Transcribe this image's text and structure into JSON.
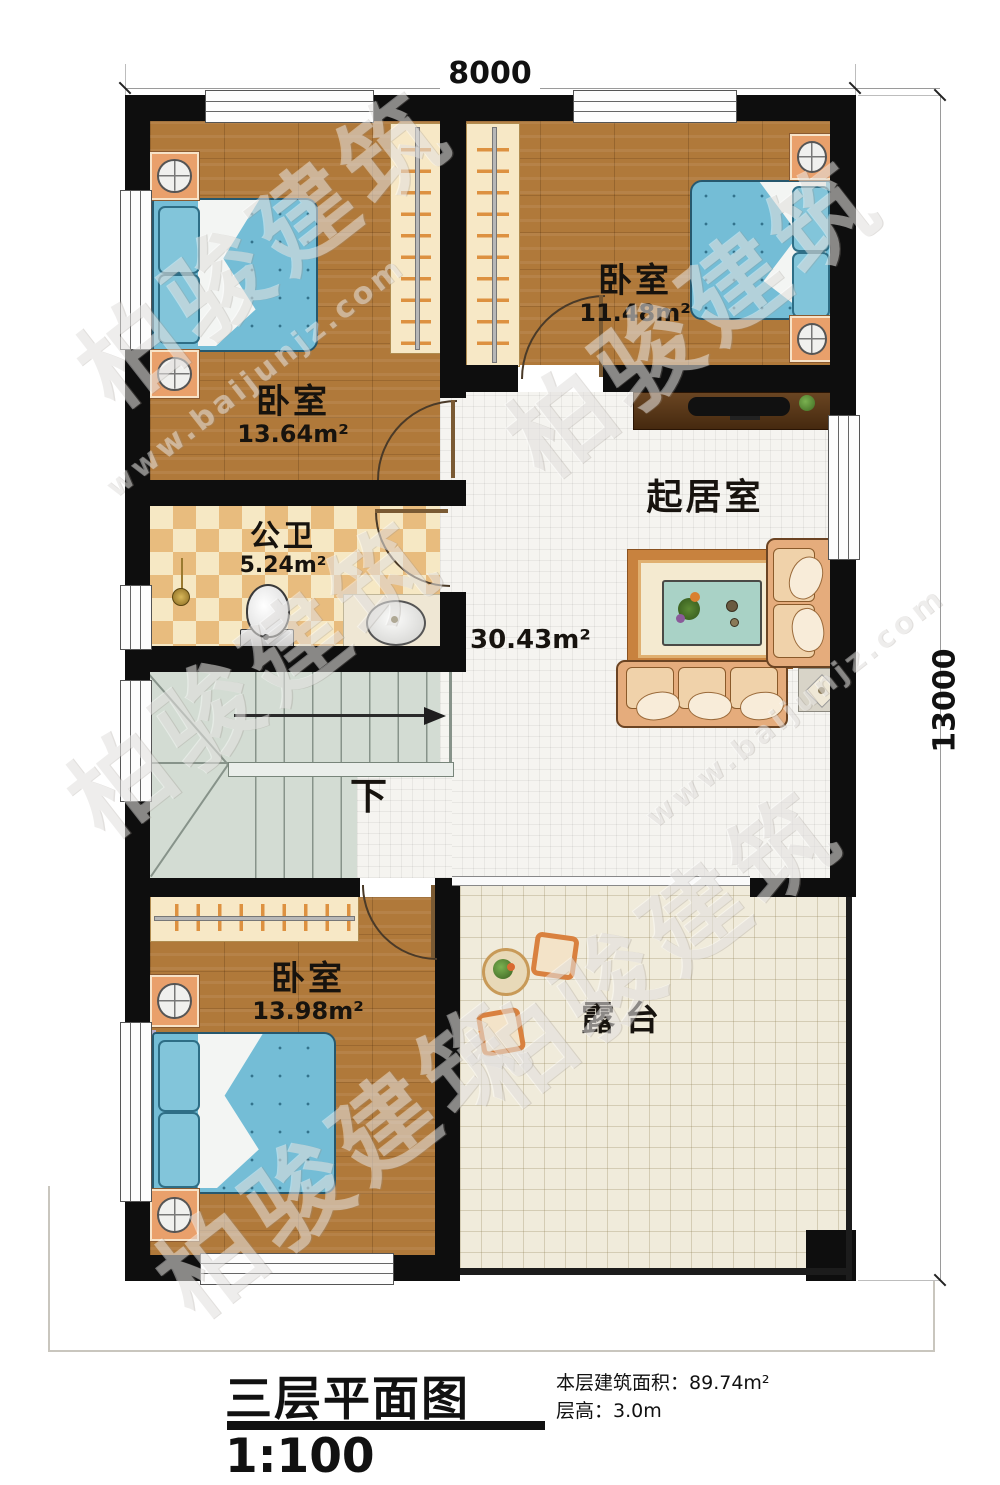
{
  "dimensions": {
    "width_top": "8000",
    "height_right": "13000"
  },
  "rooms": {
    "bedroom_top_left": {
      "name": "卧室",
      "area": "13.64m²"
    },
    "bedroom_top_right": {
      "name": "卧室",
      "area": "11.48m²"
    },
    "bathroom": {
      "name": "公卫",
      "area": "5.24m²"
    },
    "living_room": {
      "name": "起居室",
      "area": "30.43m²"
    },
    "bedroom_bottom": {
      "name": "卧室",
      "area": "13.98m²"
    },
    "terrace": {
      "name": "露台"
    }
  },
  "stairs": {
    "direction_label": "下"
  },
  "title_block": {
    "title": "三层平面图",
    "scale": "1:100",
    "area_label": "本层建筑面积：",
    "area_value": "89.74m²",
    "height_label": "层高：",
    "height_value": "3.0m"
  },
  "watermark": {
    "brand": "柏骏建筑",
    "site": "www.baijunjz.com"
  }
}
